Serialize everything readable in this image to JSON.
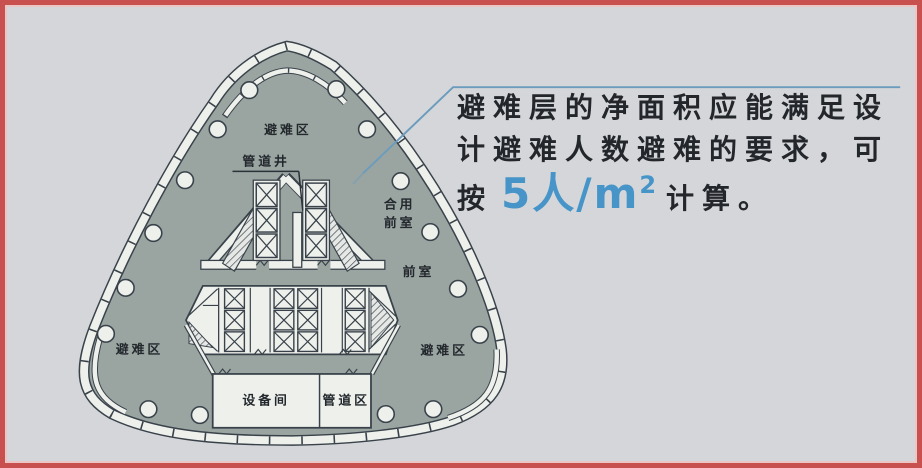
{
  "frame": {
    "border_color": "#c8504f",
    "background_color": "#d4d6d9"
  },
  "plan": {
    "labels": {
      "refuge_top": "避难区",
      "pipe_shaft": "管道井",
      "shared_lobby_line1": "合用",
      "shared_lobby_line2": "前室",
      "lobby": "前室",
      "refuge_left": "避难区",
      "refuge_right": "避难区",
      "equipment_room": "设备间",
      "pipe_zone": "管道区"
    },
    "colors": {
      "floor_fill": "#9aa5a1",
      "wall_fill": "#eef0ec",
      "wall_outline": "#39424a"
    }
  },
  "annotation": {
    "line1": "避难层的净面积应能满足设",
    "line2": "计避难人数避难的要求，可",
    "line3_prefix": "按",
    "rate": "5人/m",
    "rate_sup": "2",
    "line3_suffix": "计算。",
    "accent_color": "#4694c8",
    "leader_color": "#6b9cbd"
  }
}
